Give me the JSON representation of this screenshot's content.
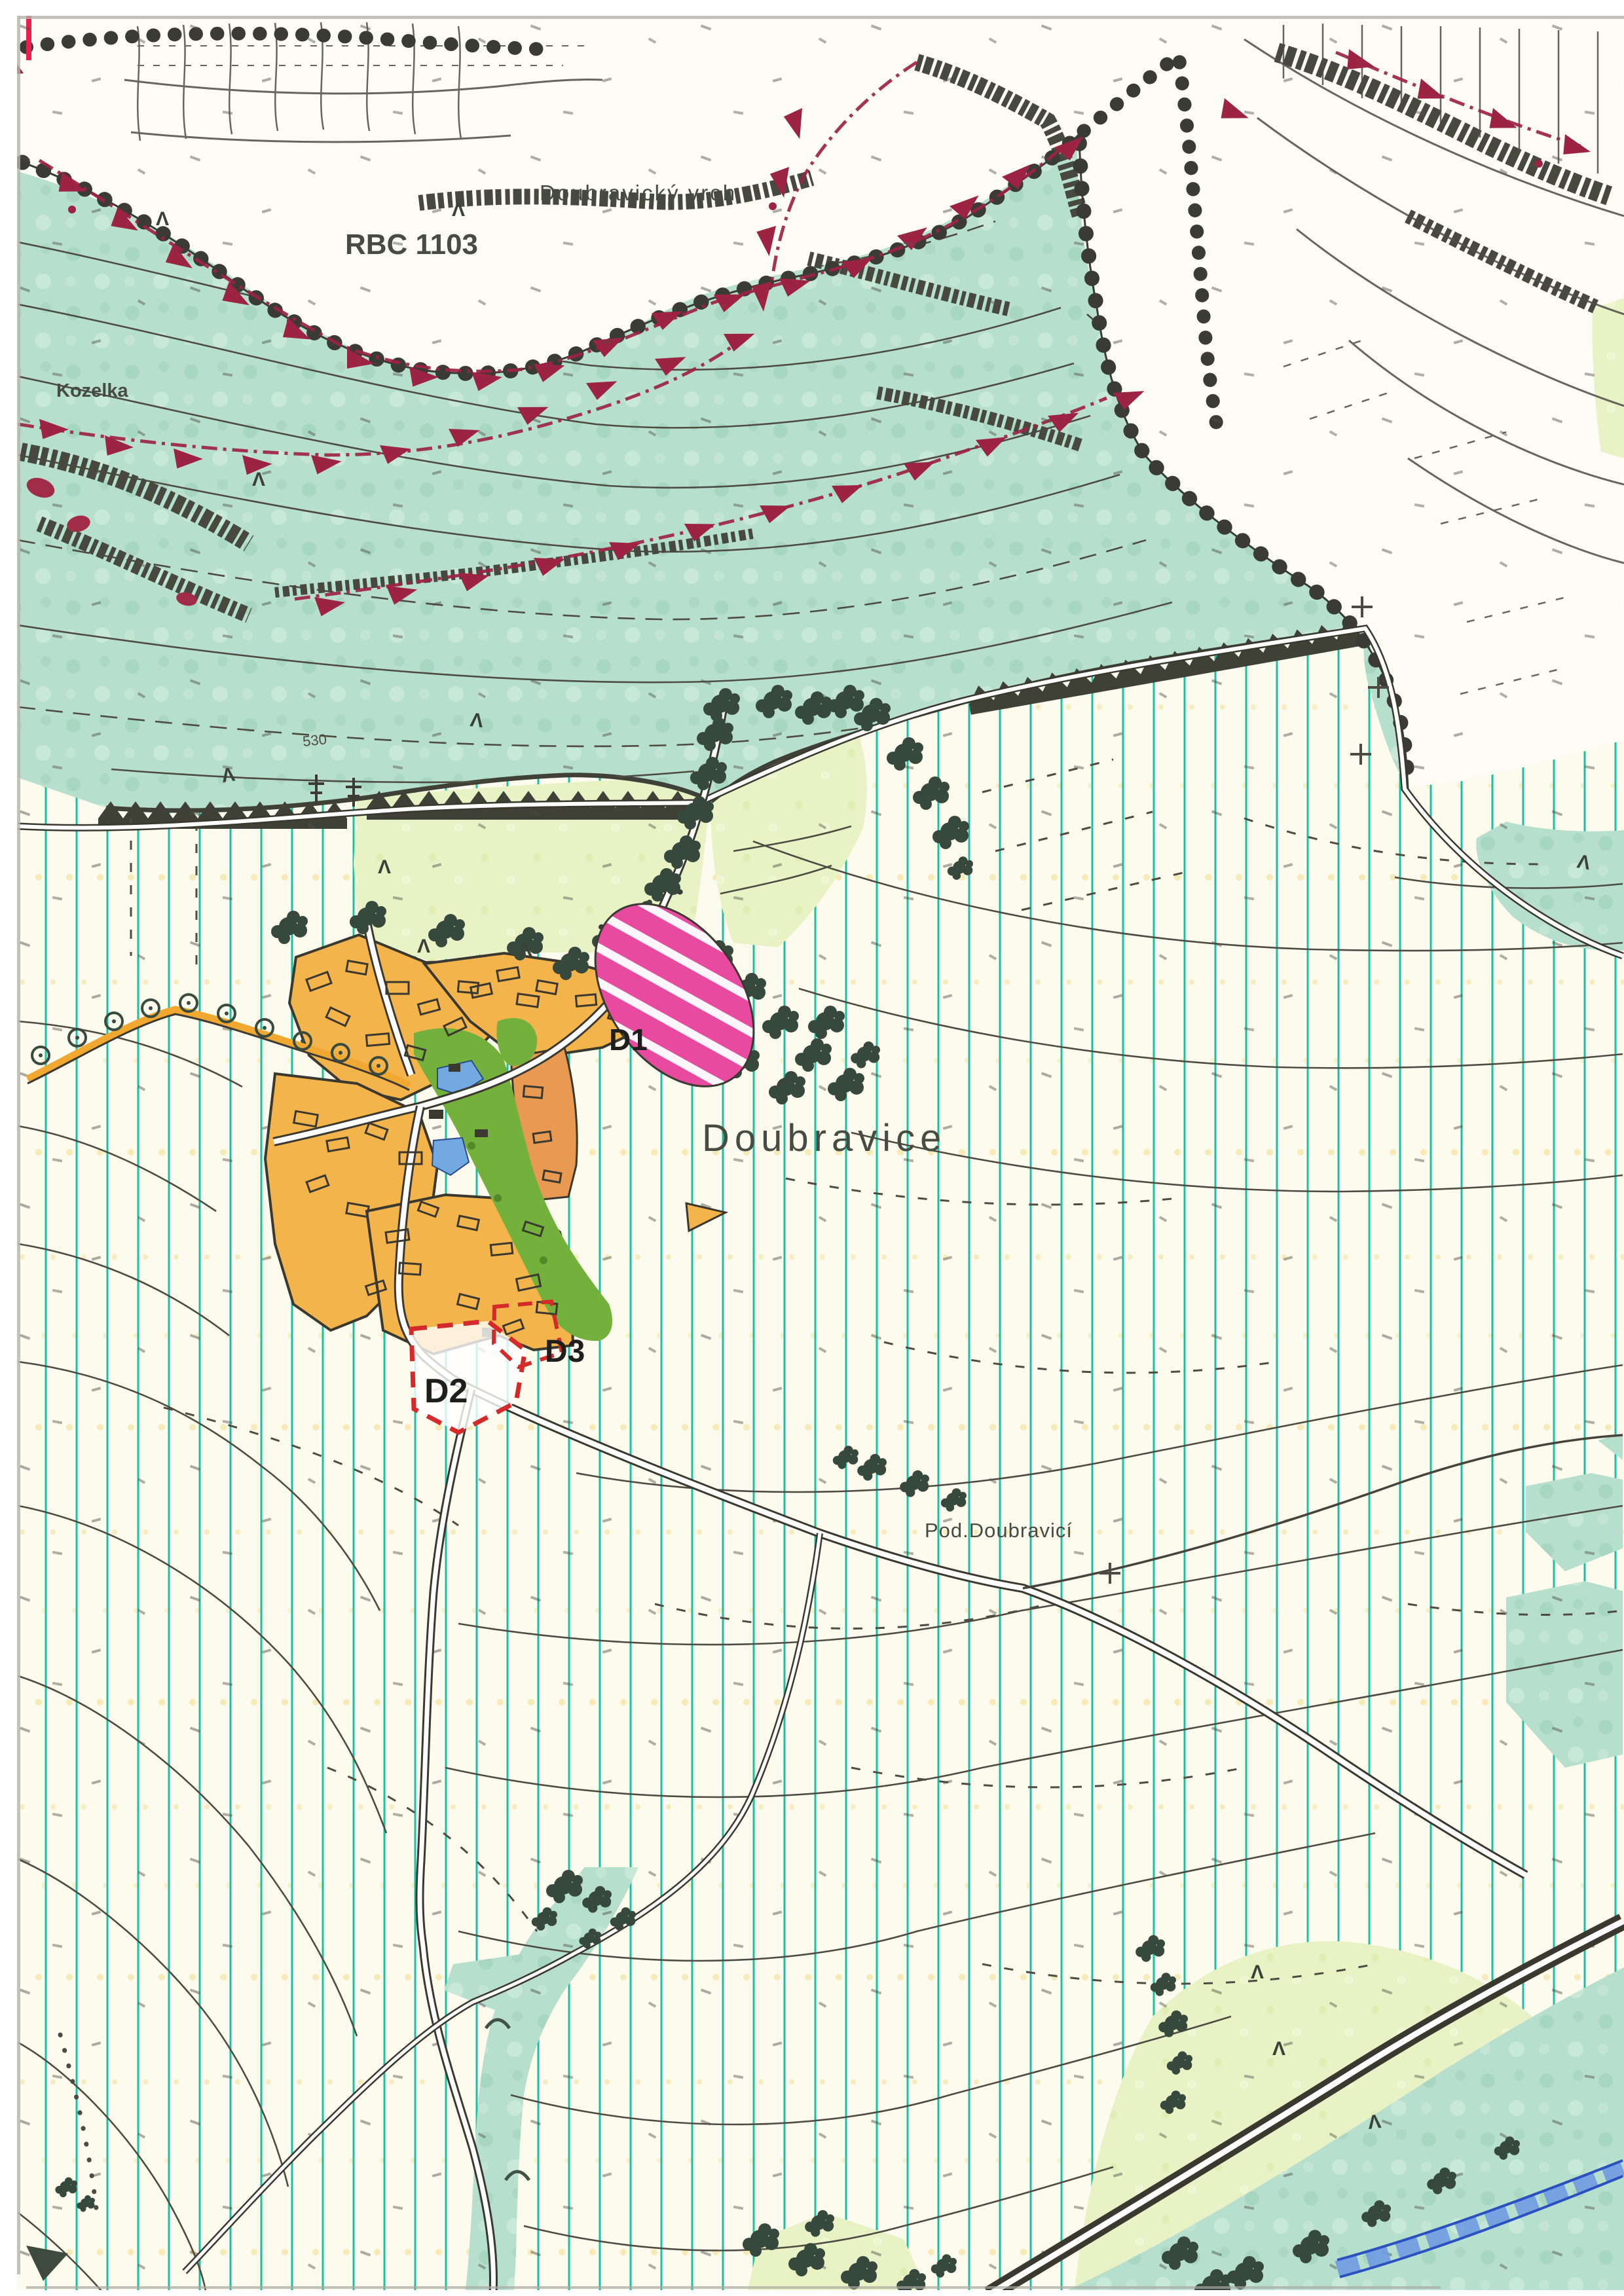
{
  "map": {
    "description": "Scanned municipal land-use plan sheet (územní plán) around the village of Doubravice",
    "labels": {
      "rbc": "RBC 1103",
      "hill": "Doubravický vrch",
      "rock_outcrop": "Kozelka",
      "village": "Doubravice",
      "locality": "Pod.Doubravicí",
      "contour_elevation": "530",
      "dev_area_1": "D1",
      "dev_area_2": "D2",
      "dev_area_3": "D3"
    },
    "palette": {
      "forest_teal": "#b6dfcd",
      "meadow_background": "#fdfaee",
      "meadow_hatch_line": "#16c29f",
      "field_pale_green": "#e9f2c5",
      "village_orange": "#f4b44c",
      "village_orange_dark": "#e89a52",
      "garden_green": "#74b13c",
      "pond_blue": "#72a9e0",
      "development_pink": "#e84aa0",
      "development_dash_red": "#d42a2a",
      "biocorridor_maroon": "#9d2342",
      "tree_dark_green": "#37493c",
      "contour_gray": "#4e4c42",
      "boundary_dot_black": "#3b3b36",
      "river_blue": "#2b50c0",
      "label_gray": "#474c42"
    }
  }
}
